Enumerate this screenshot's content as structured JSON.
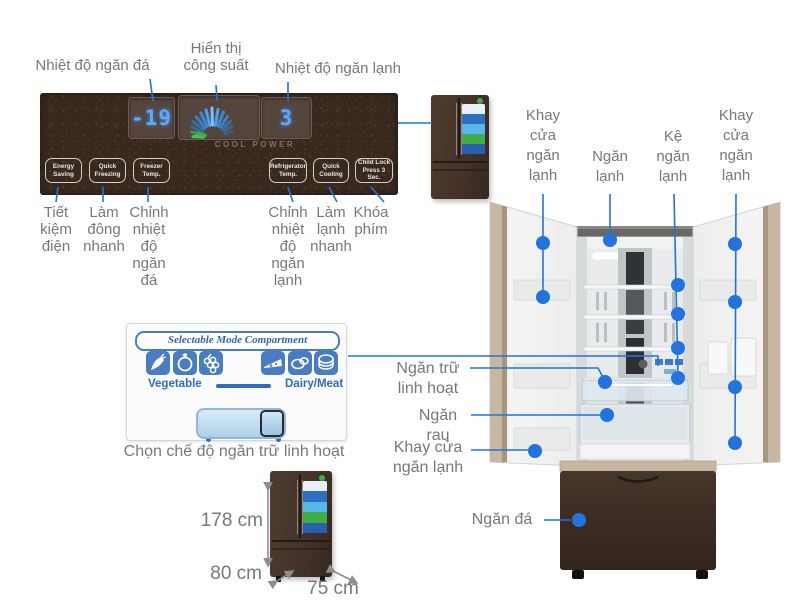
{
  "colors": {
    "accent_blue": "#2273dd",
    "label_gray": "#77787b",
    "panel_brown": "#38291f",
    "led_blue": "#59a9ff",
    "gauge_green": "#3fae49",
    "mode_blue": "#4a7cc2",
    "door_trim": "#c8b8a3",
    "freezer_brown": "#3f3029"
  },
  "control_panel": {
    "freezer_temp_value": "-19",
    "fridge_temp_value": "3",
    "cool_power_label": "COOL POWER",
    "callouts": {
      "freezer_display": "Nhiệt độ ngăn đá",
      "power_display": "Hiển thị\ncông suất",
      "fridge_display": "Nhiệt độ ngăn lạnh"
    },
    "buttons": [
      {
        "en": "Energy\nSaving",
        "vi": "Tiết\nkiệm\nđiện"
      },
      {
        "en": "Quick\nFreezing",
        "vi": "Làm\nđông\nnhanh"
      },
      {
        "en": "Freezer\nTemp.",
        "vi": "Chỉnh\nnhiệt\nđộ\nngăn\nđá"
      },
      {
        "en": "Refrigerator\nTemp.",
        "vi": "Chỉnh\nnhiệt\nđộ\nngăn\nlạnh"
      },
      {
        "en": "Quick\nCooling",
        "vi": "Làm\nlạnh\nnhanh"
      },
      {
        "en": "Child Lock\nPress 3 Sec.",
        "vi": "Khóa\nphím"
      }
    ]
  },
  "mode_panel": {
    "title": "Selectable Mode Compartment",
    "left_label": "Vegetable",
    "right_label": "Dairy/Meat",
    "caption": "Chọn chế độ ngăn trữ linh hoạt",
    "icons": [
      "carrot-icon",
      "tomato-icon",
      "grapes-icon",
      "cheese-icon",
      "meat-icon",
      "ham-slices-icon"
    ]
  },
  "dimensions": {
    "height": "178 cm",
    "width": "80 cm",
    "depth": "75 cm"
  },
  "fridge_callouts": {
    "top": [
      "Khay\ncửa\nngăn\nlạnh",
      "Ngăn\nlạnh",
      "Kệ\nngăn\nlạnh",
      "Khay\ncửa\nngăn\nlạnh"
    ],
    "left": [
      "Ngăn trữ\nlinh hoạt",
      "Ngăn rau",
      "Khay cửa\nngăn lạnh",
      "Ngăn đá"
    ]
  }
}
